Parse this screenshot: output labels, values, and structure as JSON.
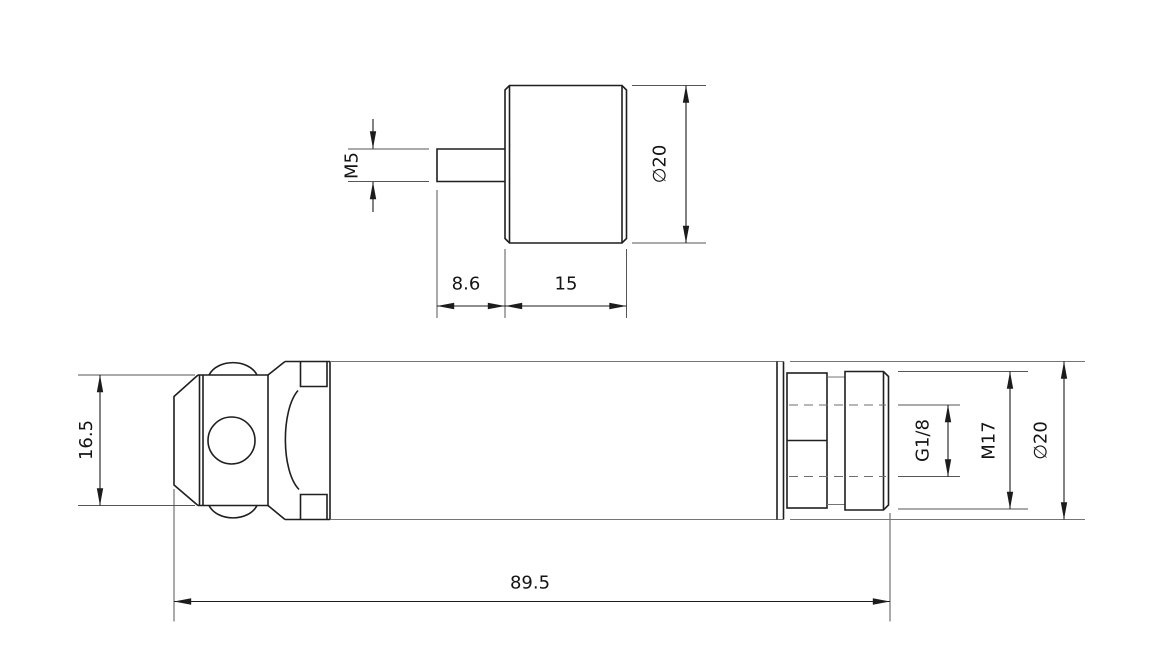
{
  "drawing": {
    "background": "#ffffff",
    "object_line_color": "#1f1f1f",
    "thin_line_color": "#757575",
    "dimension_line_color": "#1c1c1c",
    "text_color": "#141414",
    "views": [
      {
        "id": "plug-top-view",
        "dimensions": [
          {
            "id": "stud_thread",
            "label": "M5",
            "orientation": "vertical"
          },
          {
            "id": "stud_length",
            "label": "8.6",
            "orientation": "horizontal"
          },
          {
            "id": "head_length",
            "label": "15",
            "orientation": "horizontal"
          },
          {
            "id": "head_diameter",
            "label": "∅20",
            "orientation": "vertical"
          }
        ]
      },
      {
        "id": "sensor-side-view",
        "dimensions": [
          {
            "id": "hex_size",
            "label": "16.5",
            "orientation": "vertical"
          },
          {
            "id": "overall_length",
            "label": "89.5",
            "orientation": "horizontal"
          },
          {
            "id": "port_thread",
            "label": "G1/8",
            "orientation": "vertical"
          },
          {
            "id": "mount_thread",
            "label": "M17",
            "orientation": "vertical"
          },
          {
            "id": "body_diameter",
            "label": "∅20",
            "orientation": "vertical"
          }
        ]
      }
    ]
  }
}
